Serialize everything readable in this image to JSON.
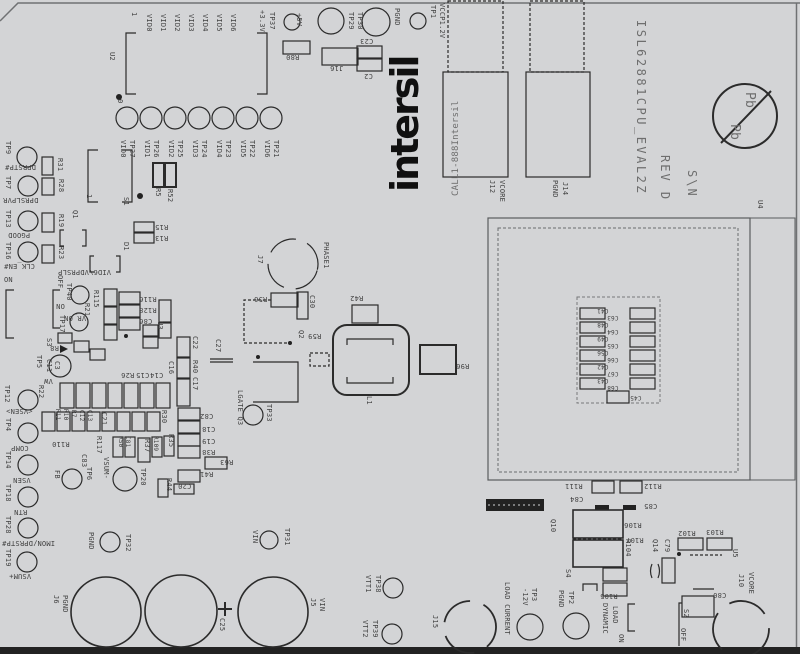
{
  "board": {
    "name": "ISL62881CPU_EVAL2Z",
    "revision": "REV D",
    "serial_label": "S\\N",
    "brand": "intersil",
    "contact": "CALL1-888Intersil",
    "colors": {
      "substrate": "#d3d4d6",
      "silkscreen_lines": "#2b2b2b",
      "text": "#3f3f3f",
      "light_text": "#6e6e6e",
      "board_edge_band": "#141414"
    },
    "labels": [
      {
        "t": "1",
        "x": 128,
        "y": 12
      },
      {
        "t": "VID0",
        "x": 143,
        "y": 14
      },
      {
        "t": "VID1",
        "x": 157,
        "y": 14
      },
      {
        "t": "VID2",
        "x": 171,
        "y": 14
      },
      {
        "t": "VID3",
        "x": 185,
        "y": 14
      },
      {
        "t": "VID4",
        "x": 199,
        "y": 14
      },
      {
        "t": "VID5",
        "x": 213,
        "y": 14
      },
      {
        "t": "VID6",
        "x": 227,
        "y": 14
      },
      {
        "t": "+3.3V",
        "x": 256,
        "y": 10
      },
      {
        "t": "TP37",
        "x": 266,
        "y": 12
      },
      {
        "t": "U2",
        "x": 106,
        "y": 52
      },
      {
        "t": "0",
        "x": 114,
        "y": 99
      },
      {
        "t": "VID0",
        "x": 117,
        "y": 140
      },
      {
        "t": "TP27",
        "x": 126,
        "y": 140
      },
      {
        "t": "VID1",
        "x": 141,
        "y": 140
      },
      {
        "t": "TP26",
        "x": 150,
        "y": 140
      },
      {
        "t": "VID2",
        "x": 165,
        "y": 140
      },
      {
        "t": "TP25",
        "x": 174,
        "y": 140
      },
      {
        "t": "VID3",
        "x": 189,
        "y": 140
      },
      {
        "t": "TP24",
        "x": 198,
        "y": 140
      },
      {
        "t": "VID4",
        "x": 213,
        "y": 140
      },
      {
        "t": "TP23",
        "x": 222,
        "y": 140
      },
      {
        "t": "VID5",
        "x": 237,
        "y": 140
      },
      {
        "t": "TP22",
        "x": 246,
        "y": 140
      },
      {
        "t": "VID6",
        "x": 261,
        "y": 140
      },
      {
        "t": "TP21",
        "x": 270,
        "y": 140
      },
      {
        "t": "+5V",
        "x": 293,
        "y": 13
      },
      {
        "t": "TP29",
        "x": 345,
        "y": 12
      },
      {
        "t": "TP30",
        "x": 354,
        "y": 12
      },
      {
        "t": "PGND",
        "x": 391,
        "y": 8
      },
      {
        "t": "TP1",
        "x": 427,
        "y": 5
      },
      {
        "t": "VCCP1.2V",
        "x": 436,
        "y": 3
      },
      {
        "t": "R80",
        "x": 286,
        "y": 53,
        "r": 180
      },
      {
        "t": "J16",
        "x": 330,
        "y": 64,
        "r": 180
      },
      {
        "t": "C23",
        "x": 360,
        "y": 37,
        "r": 180
      },
      {
        "t": "C2",
        "x": 364,
        "y": 72,
        "r": 180
      },
      {
        "t": "intersil",
        "x": 386,
        "y": 192,
        "r": -90,
        "s": 38,
        "b": 1,
        "ls": -2
      },
      {
        "t": "CALL1-888Intersil",
        "x": 452,
        "y": 196,
        "r": -90,
        "s": 9,
        "c": "light"
      },
      {
        "t": "J12",
        "x": 486,
        "y": 180
      },
      {
        "t": "VCORE",
        "x": 496,
        "y": 180
      },
      {
        "t": "PGND",
        "x": 549,
        "y": 180
      },
      {
        "t": "J14",
        "x": 559,
        "y": 182
      },
      {
        "t": "ISL62881CPU_EVAL2Z",
        "x": 633,
        "y": 20,
        "s": 12,
        "ls": 2.5,
        "c": "light"
      },
      {
        "t": "REV D",
        "x": 657,
        "y": 155,
        "s": 12,
        "ls": 2,
        "c": "light"
      },
      {
        "t": "S\\N",
        "x": 684,
        "y": 170,
        "s": 12,
        "ls": 2,
        "c": "light"
      },
      {
        "t": "U4",
        "x": 754,
        "y": 200
      },
      {
        "t": "Pb",
        "x": 741,
        "y": 92,
        "s": 13,
        "c": "light"
      },
      {
        "t": "Pb",
        "x": 726,
        "y": 124,
        "s": 13,
        "c": "light"
      },
      {
        "t": "C41",
        "x": 597,
        "y": 307,
        "r": 180,
        "s": 6
      },
      {
        "t": "C48",
        "x": 597,
        "y": 321,
        "r": 180,
        "s": 6
      },
      {
        "t": "C49",
        "x": 597,
        "y": 335,
        "r": 180,
        "s": 6
      },
      {
        "t": "C56",
        "x": 597,
        "y": 349,
        "r": 180,
        "s": 6
      },
      {
        "t": "C42",
        "x": 597,
        "y": 363,
        "r": 180,
        "s": 6
      },
      {
        "t": "C43",
        "x": 597,
        "y": 377,
        "r": 180,
        "s": 6
      },
      {
        "t": "C63",
        "x": 607,
        "y": 314,
        "r": 180,
        "s": 6
      },
      {
        "t": "C64",
        "x": 607,
        "y": 328,
        "r": 180,
        "s": 6
      },
      {
        "t": "C65",
        "x": 607,
        "y": 342,
        "r": 180,
        "s": 6
      },
      {
        "t": "C66",
        "x": 607,
        "y": 356,
        "r": 180,
        "s": 6
      },
      {
        "t": "C67",
        "x": 607,
        "y": 370,
        "r": 180,
        "s": 6
      },
      {
        "t": "C68",
        "x": 607,
        "y": 384,
        "r": 180,
        "s": 6
      },
      {
        "t": "C45",
        "x": 630,
        "y": 394,
        "r": 180,
        "s": 6
      },
      {
        "t": "R111",
        "x": 565,
        "y": 482,
        "r": 180
      },
      {
        "t": "R112",
        "x": 644,
        "y": 482,
        "r": 180
      },
      {
        "t": "C84",
        "x": 570,
        "y": 495,
        "r": 180
      },
      {
        "t": "C85",
        "x": 644,
        "y": 502,
        "r": 180
      },
      {
        "t": "Q10",
        "x": 547,
        "y": 519
      },
      {
        "t": "R106",
        "x": 624,
        "y": 521,
        "r": 180
      },
      {
        "t": "R107",
        "x": 626,
        "y": 536,
        "r": 180
      },
      {
        "t": "R104",
        "x": 622,
        "y": 539
      },
      {
        "t": "R105",
        "x": 600,
        "y": 592,
        "r": 180
      },
      {
        "t": "S4",
        "x": 562,
        "y": 569
      },
      {
        "t": "R102",
        "x": 678,
        "y": 529,
        "r": 180
      },
      {
        "t": "R103",
        "x": 706,
        "y": 528,
        "r": 180
      },
      {
        "t": "Q14",
        "x": 649,
        "y": 539
      },
      {
        "t": "C79",
        "x": 661,
        "y": 539
      },
      {
        "t": "U5",
        "x": 729,
        "y": 549
      },
      {
        "t": "J10",
        "x": 735,
        "y": 574
      },
      {
        "t": "VCORE",
        "x": 745,
        "y": 572
      },
      {
        "t": "C80",
        "x": 713,
        "y": 591,
        "r": 180
      },
      {
        "t": "S2",
        "x": 680,
        "y": 609
      },
      {
        "t": "OFF",
        "x": 677,
        "y": 628
      },
      {
        "t": "DYNAMIC",
        "x": 599,
        "y": 603
      },
      {
        "t": "LOAD",
        "x": 609,
        "y": 606
      },
      {
        "t": "ON",
        "x": 615,
        "y": 634
      },
      {
        "t": "TP9",
        "x": 2,
        "y": 141
      },
      {
        "t": "DPRSTP#",
        "x": 5,
        "y": 163,
        "r": 180
      },
      {
        "t": "R31",
        "x": 54,
        "y": 158
      },
      {
        "t": "TP7",
        "x": 2,
        "y": 176
      },
      {
        "t": "DPRSLPVR",
        "x": 3,
        "y": 196,
        "r": 180
      },
      {
        "t": "R28",
        "x": 55,
        "y": 179
      },
      {
        "t": "TP13",
        "x": 2,
        "y": 210
      },
      {
        "t": "PGOOD",
        "x": 8,
        "y": 231,
        "r": 180
      },
      {
        "t": "R19",
        "x": 55,
        "y": 214
      },
      {
        "t": "TP16",
        "x": 2,
        "y": 242
      },
      {
        "t": "CLK_EN#",
        "x": 4,
        "y": 262,
        "r": 180
      },
      {
        "t": "R23",
        "x": 55,
        "y": 246
      },
      {
        "t": "ON",
        "x": 4,
        "y": 277,
        "r": 0
      },
      {
        "t": "OFF",
        "x": 54,
        "y": 275
      },
      {
        "t": "TP40",
        "x": 63,
        "y": 283
      },
      {
        "t": "ON",
        "x": 56,
        "y": 302,
        "r": 180
      },
      {
        "t": "TP17",
        "x": 56,
        "y": 315
      },
      {
        "t": "VR_ON",
        "x": 64,
        "y": 314,
        "r": 180
      },
      {
        "t": "R21",
        "x": 81,
        "y": 303
      },
      {
        "t": "R115",
        "x": 90,
        "y": 290
      },
      {
        "t": "R116",
        "x": 139,
        "y": 295,
        "r": 180
      },
      {
        "t": "R128",
        "x": 139,
        "y": 306,
        "r": 180
      },
      {
        "t": "C86",
        "x": 139,
        "y": 317,
        "r": 180
      },
      {
        "t": "U3",
        "x": 154,
        "y": 321
      },
      {
        "t": "S1",
        "x": 120,
        "y": 197
      },
      {
        "t": "Q1",
        "x": 69,
        "y": 210
      },
      {
        "t": "1",
        "x": 83,
        "y": 194
      },
      {
        "t": "R5",
        "x": 152,
        "y": 188
      },
      {
        "t": "R52",
        "x": 164,
        "y": 189
      },
      {
        "t": "R15",
        "x": 155,
        "y": 223,
        "r": 180
      },
      {
        "t": "R13",
        "x": 155,
        "y": 234,
        "r": 180
      },
      {
        "t": "D1",
        "x": 120,
        "y": 242
      },
      {
        "t": "VID6\\VDPRSLP",
        "x": 58,
        "y": 268,
        "r": 180
      },
      {
        "t": "S3",
        "x": 43,
        "y": 338
      },
      {
        "t": "R8",
        "x": 50,
        "y": 344,
        "r": 180
      },
      {
        "t": "TP5",
        "x": 33,
        "y": 355
      },
      {
        "t": "VW",
        "x": 44,
        "y": 377,
        "r": 180
      },
      {
        "t": "C11",
        "x": 43,
        "y": 359
      },
      {
        "t": "C3",
        "x": 51,
        "y": 361
      },
      {
        "t": "TP12",
        "x": 1,
        "y": 385
      },
      {
        "t": "<VSEN>",
        "x": 6,
        "y": 407,
        "r": 180
      },
      {
        "t": "R22",
        "x": 35,
        "y": 385
      },
      {
        "t": "TP4",
        "x": 2,
        "y": 418
      },
      {
        "t": "COMP",
        "x": 11,
        "y": 444,
        "r": 180
      },
      {
        "t": "TP14",
        "x": 2,
        "y": 451
      },
      {
        "t": "VSEN",
        "x": 13,
        "y": 476,
        "r": 180
      },
      {
        "t": "TP18",
        "x": 2,
        "y": 484
      },
      {
        "t": "RTN",
        "x": 14,
        "y": 508,
        "r": 180
      },
      {
        "t": "TP28",
        "x": 2,
        "y": 516
      },
      {
        "t": "IMON/DPRSTP#",
        "x": 2,
        "y": 539,
        "r": 180
      },
      {
        "t": "TP19",
        "x": 2,
        "y": 549
      },
      {
        "t": "VSUM+",
        "x": 9,
        "y": 572,
        "r": 180
      },
      {
        "t": "R11",
        "x": 52,
        "y": 409,
        "s": 6
      },
      {
        "t": "R10",
        "x": 60,
        "y": 409,
        "s": 6
      },
      {
        "t": "R7",
        "x": 68,
        "y": 410,
        "s": 6
      },
      {
        "t": "C12",
        "x": 76,
        "y": 410,
        "s": 6
      },
      {
        "t": "C13",
        "x": 84,
        "y": 410,
        "s": 6
      },
      {
        "t": "R110",
        "x": 52,
        "y": 440,
        "r": 180
      },
      {
        "t": "C83",
        "x": 78,
        "y": 454
      },
      {
        "t": "FB",
        "x": 51,
        "y": 470
      },
      {
        "t": "TP6",
        "x": 83,
        "y": 467
      },
      {
        "t": "R117",
        "x": 93,
        "y": 436
      },
      {
        "t": "VSUM-",
        "x": 100,
        "y": 457
      },
      {
        "t": "TP20",
        "x": 137,
        "y": 468
      },
      {
        "t": "C21",
        "x": 98,
        "y": 412
      },
      {
        "t": "R30",
        "x": 158,
        "y": 410
      },
      {
        "t": "R50",
        "x": 115,
        "y": 436,
        "s": 6
      },
      {
        "t": "C81",
        "x": 122,
        "y": 436,
        "s": 6
      },
      {
        "t": "R37",
        "x": 141,
        "y": 439
      },
      {
        "t": "R109",
        "x": 150,
        "y": 436,
        "s": 6
      },
      {
        "t": "R35",
        "x": 165,
        "y": 434
      },
      {
        "t": "R44",
        "x": 163,
        "y": 478
      },
      {
        "t": "R26",
        "x": 121,
        "y": 371,
        "r": 180
      },
      {
        "t": "C15",
        "x": 136,
        "y": 371,
        "r": 180
      },
      {
        "t": "C14",
        "x": 150,
        "y": 371,
        "r": 180
      },
      {
        "t": "C16",
        "x": 165,
        "y": 361
      },
      {
        "t": "C22",
        "x": 189,
        "y": 336
      },
      {
        "t": "R40",
        "x": 189,
        "y": 360
      },
      {
        "t": "C17",
        "x": 189,
        "y": 377
      },
      {
        "t": "C27",
        "x": 212,
        "y": 339
      },
      {
        "t": "C82",
        "x": 200,
        "y": 412,
        "r": 180
      },
      {
        "t": "C18",
        "x": 202,
        "y": 425,
        "r": 180
      },
      {
        "t": "C19",
        "x": 202,
        "y": 437,
        "r": 180
      },
      {
        "t": "R38",
        "x": 202,
        "y": 448,
        "r": 180
      },
      {
        "t": "R63",
        "x": 220,
        "y": 458,
        "r": 180
      },
      {
        "t": "R41",
        "x": 200,
        "y": 470,
        "r": 180
      },
      {
        "t": "C20",
        "x": 178,
        "y": 482,
        "r": 180
      },
      {
        "t": "LGATE Q3",
        "x": 234,
        "y": 390
      },
      {
        "t": "TP33",
        "x": 263,
        "y": 404
      },
      {
        "t": "J7",
        "x": 254,
        "y": 255
      },
      {
        "t": "PHASE1",
        "x": 320,
        "y": 242
      },
      {
        "t": "R56",
        "x": 254,
        "y": 295,
        "r": 180
      },
      {
        "t": "C30",
        "x": 306,
        "y": 295
      },
      {
        "t": "Q2",
        "x": 295,
        "y": 330
      },
      {
        "t": "R59",
        "x": 308,
        "y": 332,
        "r": 180
      },
      {
        "t": "R42",
        "x": 350,
        "y": 294,
        "r": 180
      },
      {
        "t": "L1",
        "x": 363,
        "y": 396
      },
      {
        "t": "R96",
        "x": 456,
        "y": 362,
        "r": 180
      },
      {
        "t": "VIN",
        "x": 249,
        "y": 530
      },
      {
        "t": "TP31",
        "x": 281,
        "y": 528
      },
      {
        "t": "PGND",
        "x": 85,
        "y": 532
      },
      {
        "t": "TP32",
        "x": 122,
        "y": 534
      },
      {
        "t": "J6",
        "x": 50,
        "y": 595
      },
      {
        "t": "PGND",
        "x": 59,
        "y": 595
      },
      {
        "t": "C25",
        "x": 216,
        "y": 618
      },
      {
        "t": "J5",
        "x": 307,
        "y": 598
      },
      {
        "t": "VIN",
        "x": 316,
        "y": 598
      },
      {
        "t": "VTT1",
        "x": 362,
        "y": 575
      },
      {
        "t": "TP38",
        "x": 372,
        "y": 575
      },
      {
        "t": "VTT2",
        "x": 359,
        "y": 620
      },
      {
        "t": "TP39",
        "x": 369,
        "y": 620
      },
      {
        "t": "J15",
        "x": 429,
        "y": 615
      },
      {
        "t": "LOAD CURRENT",
        "x": 501,
        "y": 582
      },
      {
        "t": "-12V",
        "x": 519,
        "y": 588
      },
      {
        "t": "TP3",
        "x": 528,
        "y": 588
      },
      {
        "t": "PGND",
        "x": 555,
        "y": 590
      },
      {
        "t": "TP2",
        "x": 565,
        "y": 591
      }
    ]
  }
}
